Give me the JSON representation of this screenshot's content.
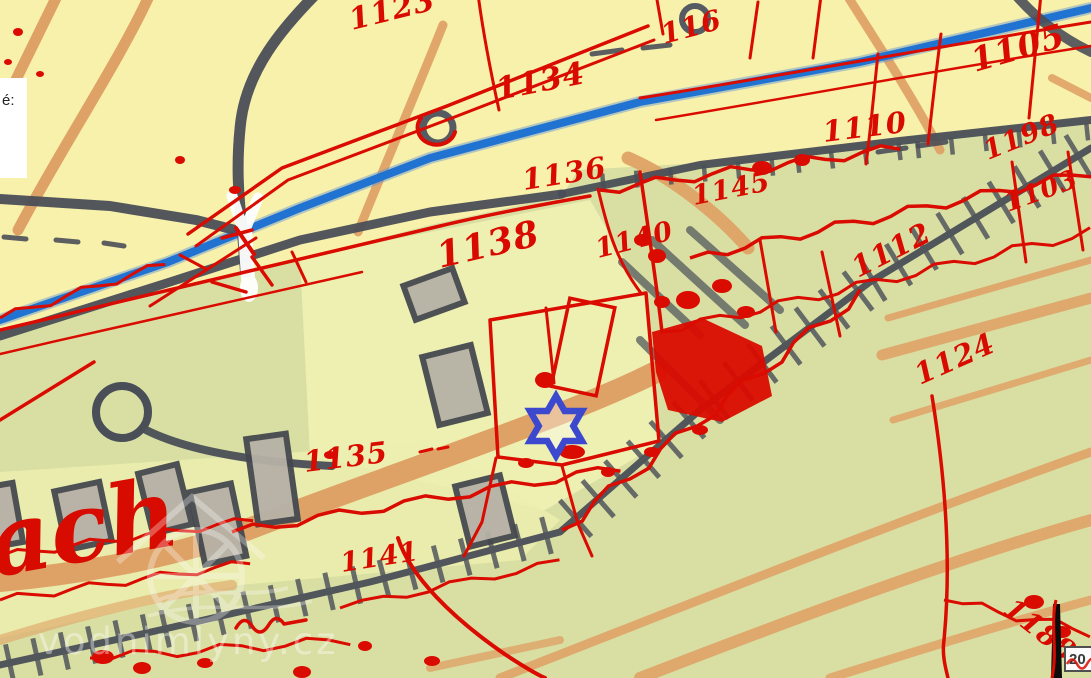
{
  "tooltip": {
    "text": "é:"
  },
  "scale": {
    "text": "20"
  },
  "watermark": {
    "text": "vodnimlyny.cz"
  },
  "map": {
    "kind": "historical cadastral map overlay on topographic base",
    "place_script": "ach",
    "marker": {
      "label": "mill location",
      "x": 556,
      "y": 426,
      "color": "#3c49cf"
    },
    "colors": {
      "field_yellow": "#f8f1ab",
      "field_green": "#d9dfa3",
      "field_light": "#eef0b2",
      "path_orange": "#dfa266",
      "road_gray": "#4a4e57",
      "stream_blue": "#2173d2",
      "overlay_red": "#da0b00",
      "building_gray": "#b6b1a6"
    },
    "parcel_numbers": [
      {
        "text": "1123",
        "x": 352,
        "y": 30,
        "rot": -14,
        "size": 30
      },
      {
        "text": "116",
        "x": 664,
        "y": 44,
        "rot": -15,
        "size": 28
      },
      {
        "text": "1134",
        "x": 498,
        "y": 100,
        "rot": -11,
        "size": 31
      },
      {
        "text": "1105",
        "x": 975,
        "y": 72,
        "rot": -16,
        "size": 33
      },
      {
        "text": "1110",
        "x": 824,
        "y": 142,
        "rot": -7,
        "size": 29
      },
      {
        "text": "1136",
        "x": 524,
        "y": 190,
        "rot": -9,
        "size": 29
      },
      {
        "text": "1198",
        "x": 988,
        "y": 160,
        "rot": -22,
        "size": 27
      },
      {
        "text": "1145",
        "x": 694,
        "y": 205,
        "rot": -11,
        "size": 27
      },
      {
        "text": "1103",
        "x": 1008,
        "y": 212,
        "rot": -20,
        "size": 26
      },
      {
        "text": "1138",
        "x": 440,
        "y": 268,
        "rot": -13,
        "size": 36
      },
      {
        "text": "1140",
        "x": 598,
        "y": 258,
        "rot": -14,
        "size": 27
      },
      {
        "text": "1112",
        "x": 858,
        "y": 278,
        "rot": -27,
        "size": 29
      },
      {
        "text": "1124",
        "x": 920,
        "y": 385,
        "rot": -24,
        "size": 29
      },
      {
        "text": "1135",
        "x": 305,
        "y": 472,
        "rot": -7,
        "size": 29
      },
      {
        "text": "1141",
        "x": 342,
        "y": 572,
        "rot": -9,
        "size": 27
      },
      {
        "text": "1188",
        "x": 1002,
        "y": 612,
        "rot": 38,
        "size": 28
      }
    ]
  }
}
